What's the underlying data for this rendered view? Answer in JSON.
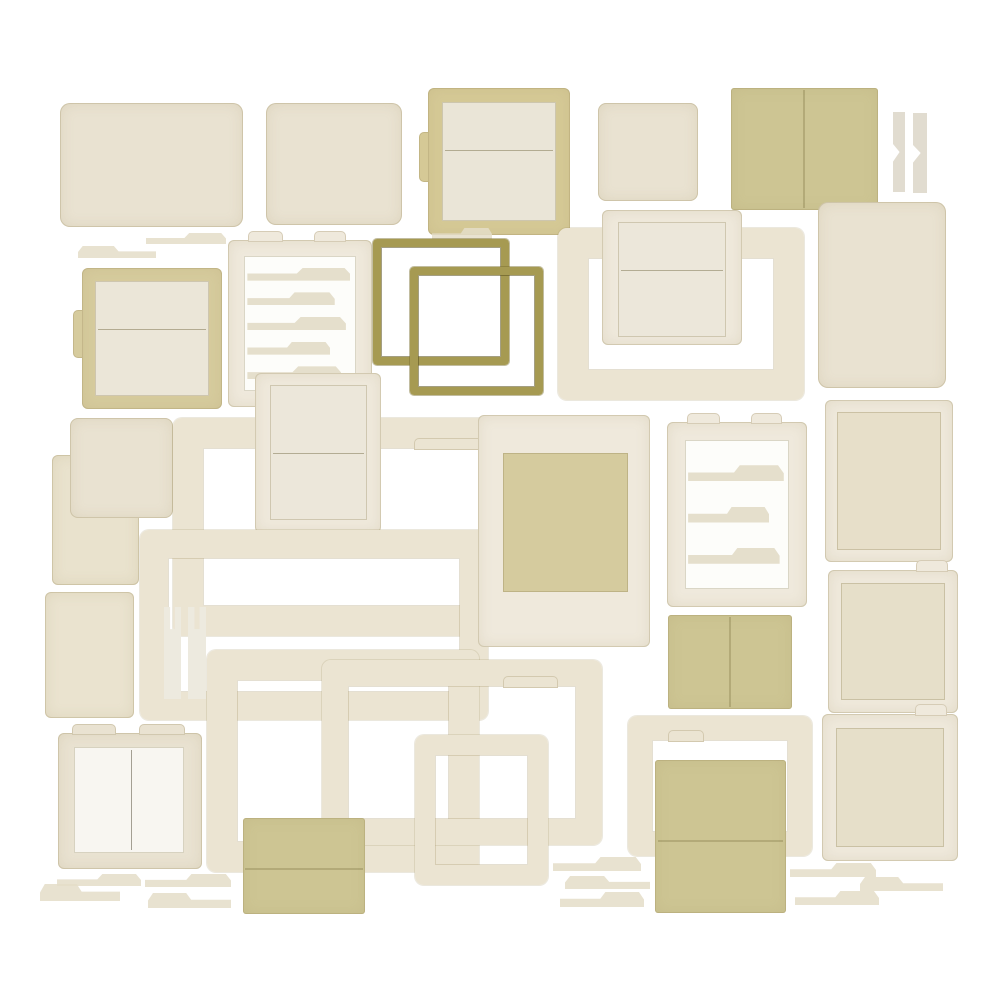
{
  "canvas": {
    "width": 1000,
    "height": 1000,
    "background": "#ffffff"
  },
  "palette": {
    "background": "#ffffff",
    "cream": "#e9e2d1",
    "frame": "#ebe4d2",
    "frame_light": "#efe9dc",
    "panel": "#e7dfc9",
    "panel_light": "#eae5d7",
    "tan_frame": "#d5c996",
    "khaki": "#cdc593",
    "olive": "#a69a52",
    "tab_fill": "#e4ddc8",
    "bookmark": "#e1dcd0",
    "fork": "#edeadf",
    "page_white": "#f8f6f1",
    "inner_cream": "#ece7da",
    "inner_khaki": "#d5cb9e",
    "tape": "#cbbf9a"
  },
  "pieces": [
    {
      "name": "card-large-1",
      "type": "card",
      "x": 60,
      "y": 103,
      "w": 183,
      "h": 124,
      "r": 10
    },
    {
      "name": "card-large-2",
      "type": "card",
      "x": 266,
      "y": 103,
      "w": 136,
      "h": 122,
      "r": 10
    },
    {
      "name": "framed-panel-1",
      "type": "panelframe",
      "x": 428,
      "y": 88,
      "w": 142,
      "h": 147,
      "b": 14,
      "frameColor": "#d5c996",
      "panelColor": "#eae5d7",
      "divider": 0.4,
      "tab": "left"
    },
    {
      "name": "card-square-1",
      "type": "card",
      "x": 598,
      "y": 103,
      "w": 100,
      "h": 98,
      "r": 8
    },
    {
      "name": "folded-paper-1",
      "type": "khaki",
      "x": 731,
      "y": 88,
      "w": 147,
      "h": 122,
      "crease": "v"
    },
    {
      "name": "bookmark-strip-1",
      "type": "bookmark",
      "x": 893,
      "y": 112,
      "w": 12,
      "h": 80
    },
    {
      "name": "bookmark-strip-2",
      "type": "bookmark",
      "x": 913,
      "y": 113,
      "w": 14,
      "h": 80
    },
    {
      "name": "tab-strip-1",
      "type": "tabstrip",
      "x": 146,
      "y": 233,
      "w": 80,
      "h": 11
    },
    {
      "name": "tab-strip-2",
      "type": "tabstrip",
      "x": 78,
      "y": 246,
      "w": 78,
      "h": 12,
      "flip": true
    },
    {
      "name": "tabbed-sheet-1",
      "type": "tabsheet",
      "x": 228,
      "y": 240,
      "w": 144,
      "h": 167,
      "b": 16,
      "tabs": 5
    },
    {
      "name": "tab-strip-13",
      "type": "tabstrip",
      "x": 432,
      "y": 228,
      "w": 60,
      "h": 12
    },
    {
      "name": "square-frame-1",
      "type": "frame2",
      "x": 373,
      "y": 239,
      "w": 136,
      "h": 126,
      "b": 8
    },
    {
      "name": "square-frame-2",
      "type": "frame2",
      "x": 410,
      "y": 267,
      "w": 133,
      "h": 128,
      "b": 8
    },
    {
      "name": "photo-frame-large-1",
      "type": "frame",
      "x": 558,
      "y": 228,
      "w": 246,
      "h": 172,
      "b": 30,
      "tab": "tl"
    },
    {
      "name": "photo-card-1",
      "type": "polaroid",
      "x": 602,
      "y": 210,
      "w": 140,
      "h": 135,
      "pad": [
        12,
        16,
        16,
        8
      ],
      "innerColor": "#ece7da",
      "divider": 0.42
    },
    {
      "name": "card-tall-1",
      "type": "card",
      "x": 818,
      "y": 202,
      "w": 128,
      "h": 186,
      "r": 10
    },
    {
      "name": "framed-panel-2",
      "type": "panelframe",
      "x": 82,
      "y": 268,
      "w": 140,
      "h": 141,
      "b": 13,
      "frameColor": "#d6cb9d",
      "panelColor": "#ebe6d8",
      "divider": 0.42,
      "tab": "left"
    },
    {
      "name": "paper-sheet-1",
      "type": "card",
      "x": 52,
      "y": 455,
      "w": 87,
      "h": 130,
      "r": 6,
      "color": "#e9e2cd"
    },
    {
      "name": "card-square-2",
      "type": "card",
      "x": 70,
      "y": 418,
      "w": 103,
      "h": 100,
      "r": 8
    },
    {
      "name": "paper-sheet-2",
      "type": "card",
      "x": 45,
      "y": 592,
      "w": 89,
      "h": 126,
      "r": 6,
      "color": "#eae3cf"
    },
    {
      "name": "photo-frame-large-2",
      "type": "frame",
      "x": 173,
      "y": 418,
      "w": 370,
      "h": 218,
      "b": 30,
      "tab": "tr"
    },
    {
      "name": "photo-card-tall-1",
      "type": "polaroid",
      "x": 255,
      "y": 373,
      "w": 126,
      "h": 160,
      "pad": [
        12,
        15,
        14,
        13
      ],
      "innerColor": "#ece7da",
      "divider": 0.5
    },
    {
      "name": "photo-frame-large-3",
      "type": "frame",
      "x": 140,
      "y": 530,
      "w": 348,
      "h": 190,
      "b": 28
    },
    {
      "name": "fork-strip-1",
      "type": "forkstrip",
      "x": 164,
      "y": 607,
      "w": 17,
      "h": 92
    },
    {
      "name": "fork-strip-2",
      "type": "forkstrip",
      "x": 188,
      "y": 607,
      "w": 18,
      "h": 92
    },
    {
      "name": "photo-frame-large-4",
      "type": "frame",
      "x": 207,
      "y": 650,
      "w": 272,
      "h": 222,
      "b": 30
    },
    {
      "name": "photo-frame-large-5",
      "type": "frame",
      "x": 322,
      "y": 660,
      "w": 280,
      "h": 185,
      "b": 26,
      "tab": "tr"
    },
    {
      "name": "photo-frame-small-1",
      "type": "frame",
      "x": 415,
      "y": 735,
      "w": 133,
      "h": 150,
      "b": 20
    },
    {
      "name": "photo-card-2",
      "type": "polaroid",
      "x": 478,
      "y": 415,
      "w": 172,
      "h": 232,
      "pad": [
        38,
        25,
        22,
        55
      ],
      "innerColor": "#d5cb9e"
    },
    {
      "name": "tabbed-sheet-2",
      "type": "tabsheet",
      "x": 667,
      "y": 422,
      "w": 140,
      "h": 185,
      "b": 18,
      "tabs": 3
    },
    {
      "name": "framed-panel-3",
      "type": "panelframe",
      "x": 825,
      "y": 400,
      "w": 128,
      "h": 162,
      "b": 12,
      "frameColor": "#efe9dc",
      "panelColor": "#e7dfc9"
    },
    {
      "name": "folded-paper-2",
      "type": "khaki",
      "x": 668,
      "y": 615,
      "w": 124,
      "h": 94,
      "crease": "v"
    },
    {
      "name": "framed-panel-4",
      "type": "panelframe",
      "x": 828,
      "y": 570,
      "w": 130,
      "h": 143,
      "b": 13,
      "frameColor": "#efe9dc",
      "panelColor": "#e6dfc9",
      "tab": "tr"
    },
    {
      "name": "framed-panel-5",
      "type": "panelframe",
      "x": 822,
      "y": 714,
      "w": 136,
      "h": 147,
      "b": 14,
      "frameColor": "#efe9dc",
      "panelColor": "#e6dfc9",
      "tab": "tr"
    },
    {
      "name": "book-frame-1",
      "type": "bookframe",
      "x": 58,
      "y": 733,
      "w": 144,
      "h": 136
    },
    {
      "name": "folded-paper-3",
      "type": "khaki",
      "x": 243,
      "y": 818,
      "w": 122,
      "h": 96,
      "crease": "h"
    },
    {
      "name": "folder-frame-1",
      "type": "frame",
      "x": 628,
      "y": 716,
      "w": 184,
      "h": 140,
      "b": 24,
      "tab": "tl"
    },
    {
      "name": "folded-paper-4",
      "type": "khaki",
      "x": 655,
      "y": 760,
      "w": 131,
      "h": 153,
      "crease": "h"
    },
    {
      "name": "tab-strip-3",
      "type": "tabstrip",
      "x": 57,
      "y": 874,
      "w": 84,
      "h": 12
    },
    {
      "name": "tab-strip-4",
      "type": "tabstrip",
      "x": 40,
      "y": 884,
      "w": 80,
      "h": 17,
      "flip": true
    },
    {
      "name": "tab-strip-5",
      "type": "tabstrip",
      "x": 145,
      "y": 874,
      "w": 86,
      "h": 13
    },
    {
      "name": "tab-strip-6",
      "type": "tabstrip",
      "x": 148,
      "y": 893,
      "w": 83,
      "h": 15,
      "flip": true
    },
    {
      "name": "tab-strip-7",
      "type": "tabstrip",
      "x": 553,
      "y": 857,
      "w": 88,
      "h": 14
    },
    {
      "name": "tab-strip-8",
      "type": "tabstrip",
      "x": 565,
      "y": 876,
      "w": 85,
      "h": 13,
      "flip": true
    },
    {
      "name": "tab-strip-9",
      "type": "tabstrip",
      "x": 560,
      "y": 892,
      "w": 84,
      "h": 15
    },
    {
      "name": "tab-strip-10",
      "type": "tabstrip",
      "x": 790,
      "y": 863,
      "w": 86,
      "h": 14
    },
    {
      "name": "tab-strip-11",
      "type": "tabstrip",
      "x": 860,
      "y": 877,
      "w": 83,
      "h": 14,
      "flip": true
    },
    {
      "name": "tab-strip-12",
      "type": "tabstrip",
      "x": 795,
      "y": 891,
      "w": 84,
      "h": 14
    }
  ]
}
